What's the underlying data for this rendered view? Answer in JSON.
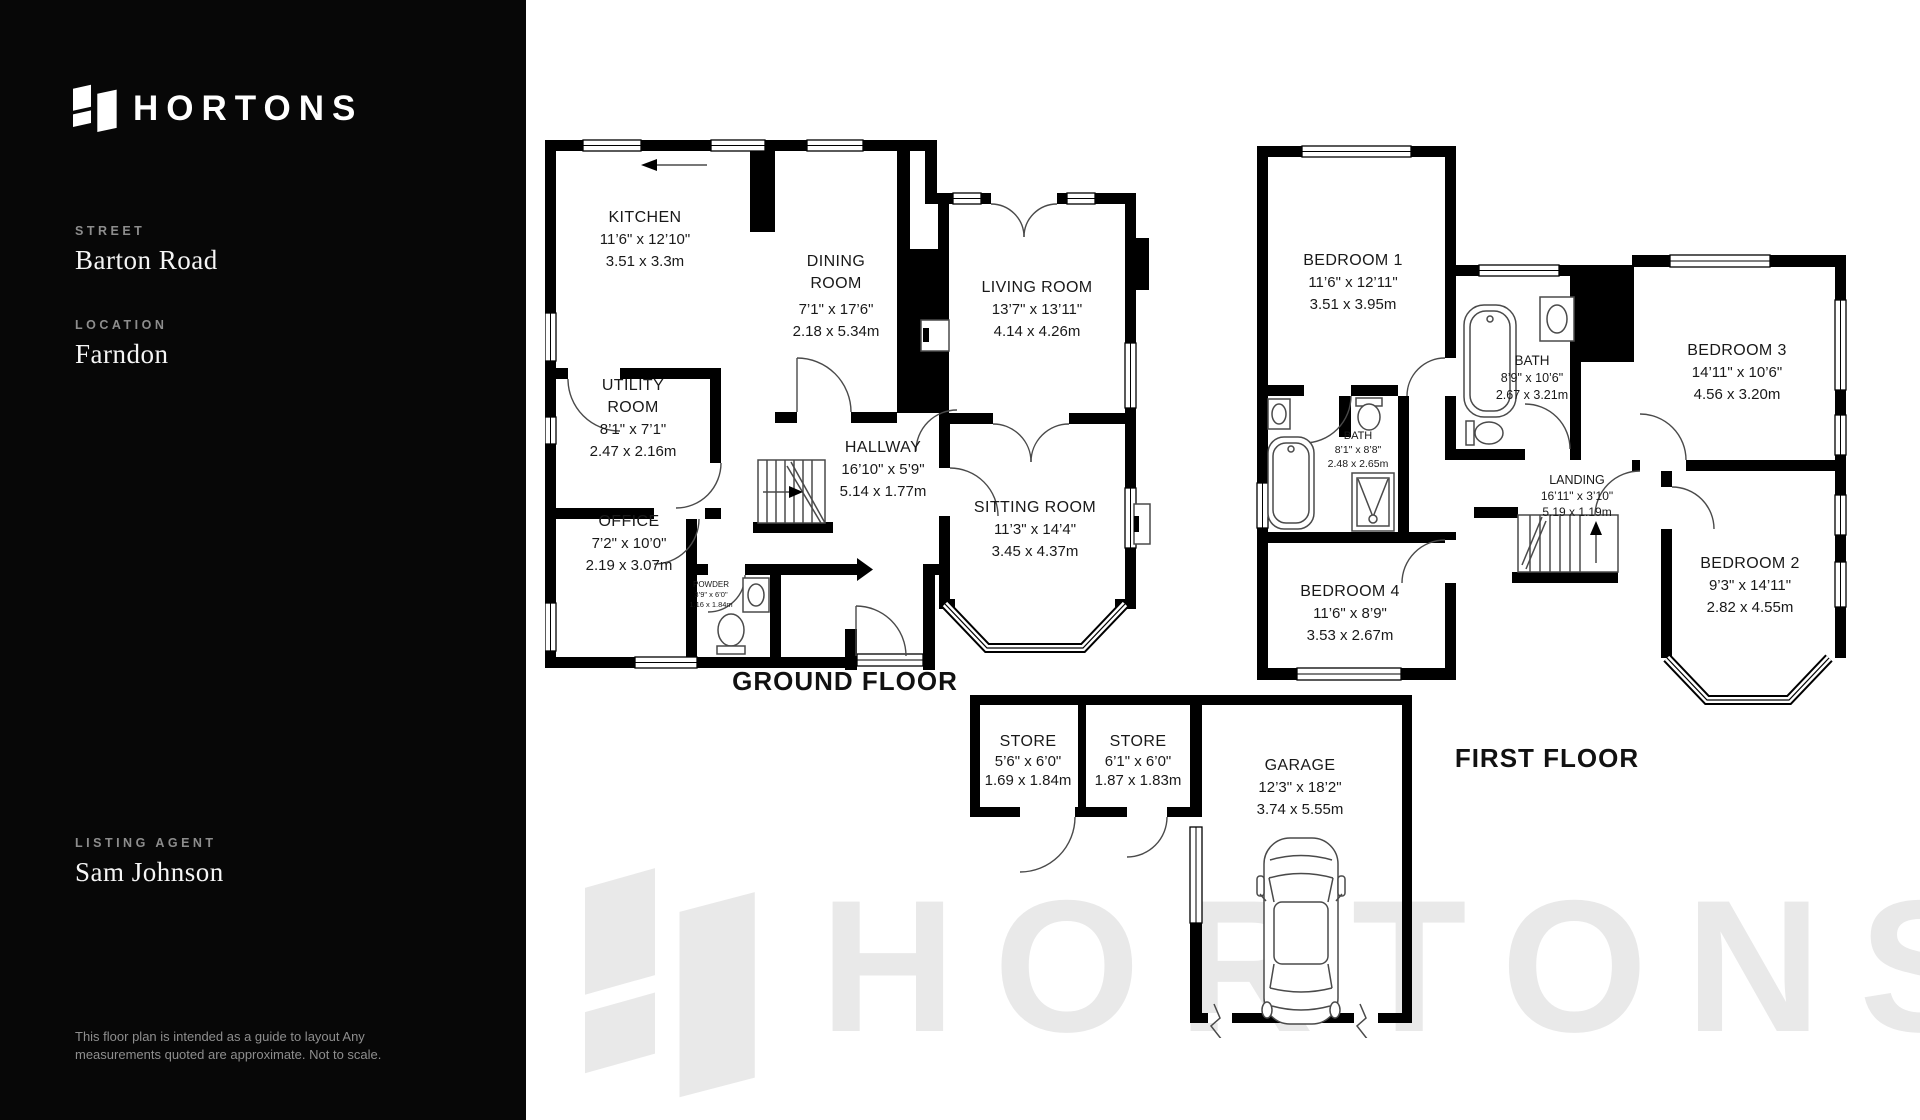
{
  "sidebar": {
    "brand": "HORTONS",
    "fields": [
      {
        "label": "STREET",
        "value": "Barton Road"
      },
      {
        "label": "LOCATION",
        "value": "Farndon"
      },
      {
        "label": "LISTING AGENT",
        "value": "Sam Johnson"
      }
    ],
    "disclaimer": "This floor plan is intended  as a guide to layout Any measurements quoted are approximate. Not to scale."
  },
  "watermark": {
    "text": "HORTONS"
  },
  "colors": {
    "sidebar_bg": "#070707",
    "wall": "#000000",
    "watermark": "#e9e9e9",
    "plan_text": "#191919"
  },
  "floors": {
    "ground": {
      "label": "GROUND FLOOR",
      "rooms": {
        "kitchen": {
          "name": "KITCHEN",
          "imperial": "11’6\" x 12’10\"",
          "metric": "3.51 x 3.3m"
        },
        "dining": {
          "name": "DINING",
          "name2": "ROOM",
          "imperial": "7’1\" x 17’6\"",
          "metric": "2.18 x 5.34m"
        },
        "living": {
          "name": "LIVING ROOM",
          "imperial": "13’7\" x 13’11\"",
          "metric": "4.14 x 4.26m"
        },
        "utility": {
          "name": "UTILITY",
          "name2": "ROOM",
          "imperial": "8’1\" x 7’1\"",
          "metric": "2.47 x 2.16m"
        },
        "hallway": {
          "name": "HALLWAY",
          "imperial": "16’10\" x 5’9\"",
          "metric": "5.14 x 1.77m"
        },
        "office": {
          "name": "OFFICE",
          "imperial": "7’2\" x 10’0\"",
          "metric": "2.19 x 3.07m"
        },
        "powder": {
          "name": "POWDER",
          "imperial": "3’9\" x 6’0\"",
          "metric": "1.16 x 1.84m"
        },
        "sitting": {
          "name": "SITTING ROOM",
          "imperial": "11’3\" x 14’4\"",
          "metric": "3.45 x 4.37m"
        }
      }
    },
    "first": {
      "label": "FIRST FLOOR",
      "rooms": {
        "bedroom1": {
          "name": "BEDROOM 1",
          "imperial": "11’6\" x 12’11\"",
          "metric": "3.51 x 3.95m"
        },
        "bath_main": {
          "name": "BATH",
          "imperial": "8’9\" x 10’6\"",
          "metric": "2.67 x 3.21m"
        },
        "bath_ensuite": {
          "name": "BATH",
          "imperial": "8’1\" x 8’8\"",
          "metric": "2.48 x 2.65m"
        },
        "bedroom3": {
          "name": "BEDROOM 3",
          "imperial": "14’11\" x 10’6\"",
          "metric": "4.56 x 3.20m"
        },
        "landing": {
          "name": "LANDING",
          "imperial": "16’11\" x 3’10\"",
          "metric": "5.19 x 1.19m"
        },
        "bedroom4": {
          "name": "BEDROOM 4",
          "imperial": "11’6\" x 8’9\"",
          "metric": "3.53 x 2.67m"
        },
        "bedroom2": {
          "name": "BEDROOM 2",
          "imperial": "9’3\" x 14’11\"",
          "metric": "2.82 x 4.55m"
        }
      }
    },
    "outbuilding": {
      "rooms": {
        "store1": {
          "name": "STORE",
          "imperial": "5’6\" x 6’0\"",
          "metric": "1.69 x 1.84m"
        },
        "store2": {
          "name": "STORE",
          "imperial": "6’1\" x 6’0\"",
          "metric": "1.87 x 1.83m"
        },
        "garage": {
          "name": "GARAGE",
          "imperial": "12’3\" x 18’2\"",
          "metric": "3.74 x 5.55m"
        }
      }
    }
  }
}
